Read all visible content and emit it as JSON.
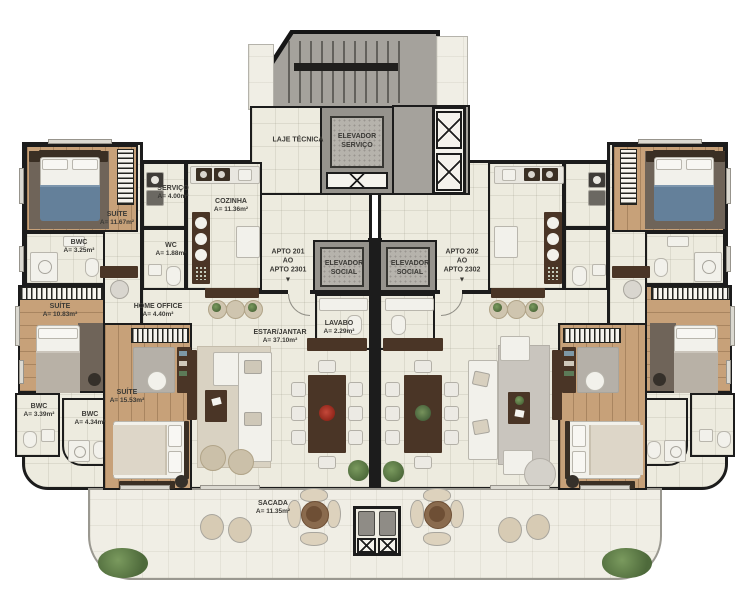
{
  "labels": {
    "laje_tecnica": {
      "line1": "LAJE TÉCNICA"
    },
    "elevador_servico": {
      "line1": "ELEVADOR",
      "line2": "SERVIÇO"
    },
    "elevador_social_left": {
      "line1": "ELEVADOR",
      "line2": "SOCIAL"
    },
    "elevador_social_right": {
      "line1": "ELEVADOR",
      "line2": "SOCIAL"
    },
    "apto_left": {
      "line1": "APTO 201",
      "line2": "AO",
      "line3": "APTO 2301",
      "arrow": "▼"
    },
    "apto_right": {
      "line1": "APTO 202",
      "line2": "AO",
      "line3": "APTO 2302",
      "arrow": "▼"
    },
    "suite_top_left": {
      "line1": "SUÍTE",
      "line2": "A= 11.67m²"
    },
    "servico": {
      "line1": "SERVIÇO",
      "line2": "A= 4.00m²"
    },
    "cozinha": {
      "line1": "COZINHA",
      "line2": "A= 11.36m²"
    },
    "bwc_top": {
      "line1": "BWC",
      "line2": "A= 3.25m²"
    },
    "wc": {
      "line1": "WC",
      "line2": "A= 1.88m²"
    },
    "home_office": {
      "line1": "HOME OFFICE",
      "line2": "A= 4.40m²"
    },
    "suite_mid": {
      "line1": "SUÍTE",
      "line2": "A= 10.83m²"
    },
    "bwc_mid": {
      "line1": "BWC",
      "line2": "A= 3.39m²"
    },
    "bwc_bottom": {
      "line1": "BWC",
      "line2": "A= 4.34m²"
    },
    "suite_bottom": {
      "line1": "SUÍTE",
      "line2": "A= 15.53m²"
    },
    "estar_jantar": {
      "line1": "ESTAR/JANTAR",
      "line2": "A= 37.10m²"
    },
    "lavabo": {
      "line1": "LAVABO",
      "line2": "A= 2.29m²"
    },
    "sacada": {
      "line1": "SACADA",
      "line2": "A= 11.35m²"
    }
  },
  "colors": {
    "wall": "#1c1c1c",
    "floor_tile": "#edebdf",
    "wood": "#c7a179",
    "concrete": "#a5a29c",
    "blanket_blue": "#64809a",
    "dark_wood": "#4a3526",
    "plant_green": "#5f7c49",
    "centerpiece_red": "#a33020"
  }
}
